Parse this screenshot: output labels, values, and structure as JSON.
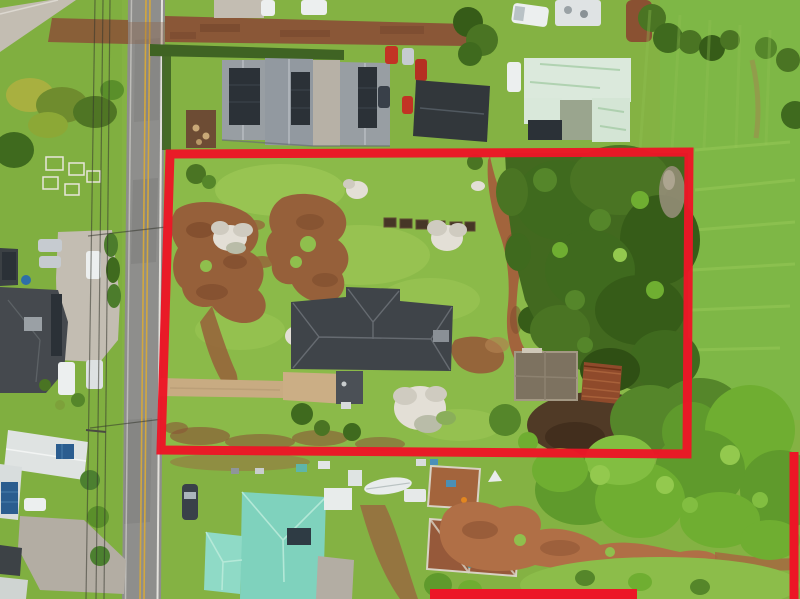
{
  "scene": {
    "boundary": {
      "main_points": "170,154 689,152 687,454 161,450",
      "seg_bottom": "M430 594 L637 594",
      "seg_right": "M794 452 L794 599",
      "color": "#ec1626",
      "width": "9"
    },
    "colors": {
      "lawn": "#84b243",
      "property_lawn": "#92c14e",
      "field_grass": "#7eb746",
      "road_asphalt": "#8e8e8c",
      "road_line_yellow": "#d2a73e",
      "road_line_white": "#eceae4",
      "dirt_road": "#8a5737",
      "dirt_red": "#96603a",
      "dirt_path": "#a2643c",
      "dirt_field": "#b06f46",
      "soil_dark": "#503a26",
      "driveway_tan": "#c8ab82",
      "roof_main_house": "#3f4449",
      "roof_gray": "#989ea3",
      "roof_black": "#32373b",
      "roof_mint": "#dbe9dc",
      "roof_teal": "#7fd2bd",
      "roof_teal_light": "#8fdac6",
      "roof_white": "#dfe3e2",
      "roof_rust": "#8f4a2b",
      "solar_dark": "#2b3137",
      "solar_blue": "#2b5d8f",
      "forest_dark": "#42691f",
      "ruin_concrete": "#7d7260"
    }
  }
}
